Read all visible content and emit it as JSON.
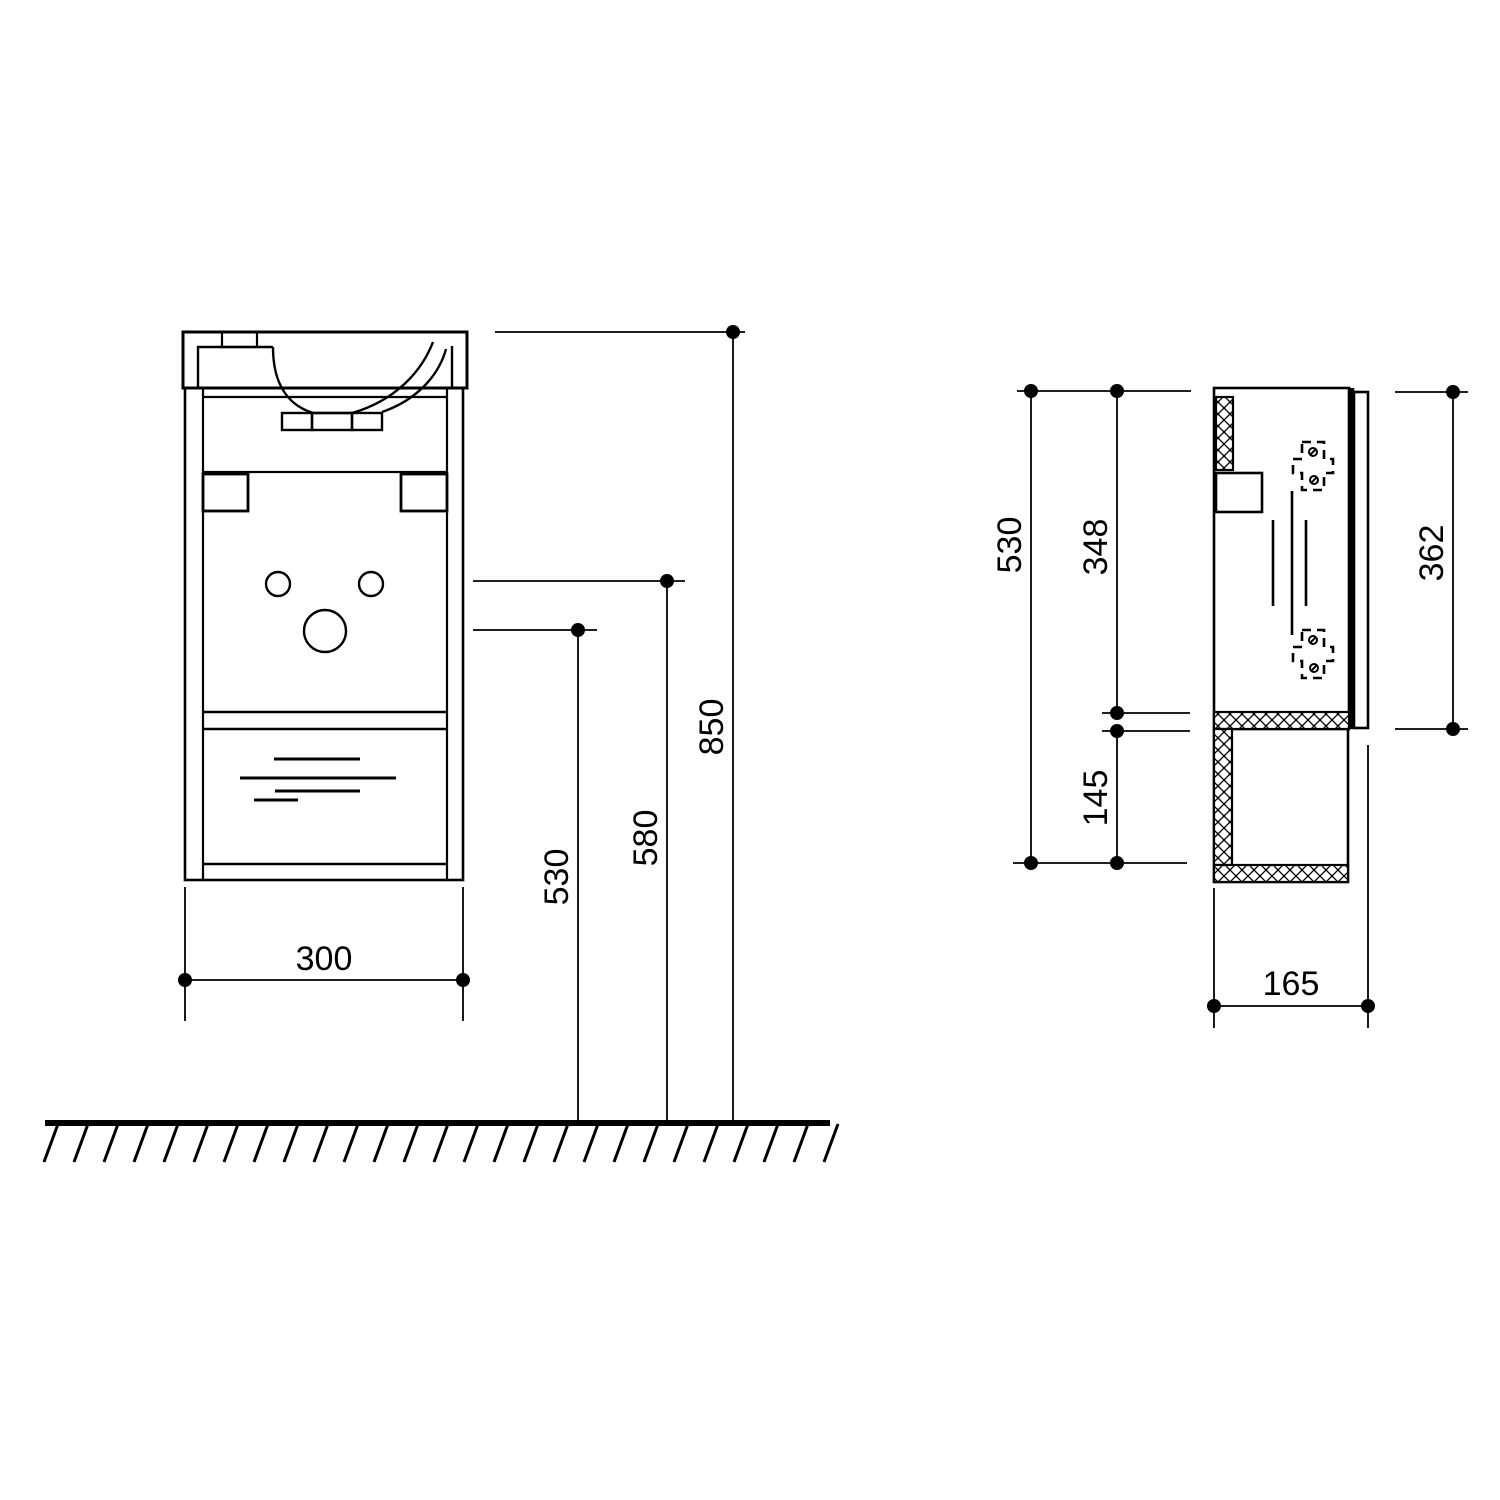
{
  "colors": {
    "background": "#ffffff",
    "line": "#000000"
  },
  "front_view": {
    "dim_width": "300",
    "dim_height_total": "850",
    "dim_height_mid": "580",
    "dim_height_low": "530"
  },
  "side_view": {
    "dim_height_total": "530",
    "dim_upper_section": "348",
    "dim_lower_section": "145",
    "dim_front_panel": "362",
    "dim_depth": "165"
  }
}
